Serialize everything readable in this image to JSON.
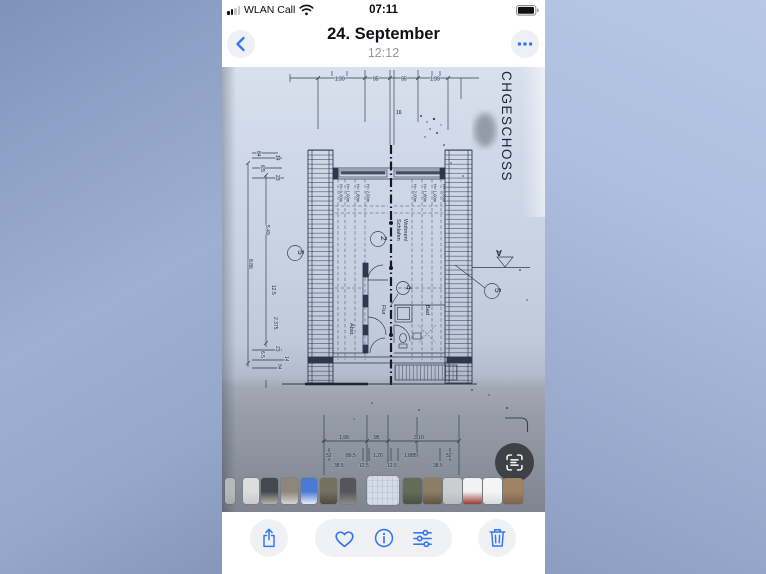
{
  "status": {
    "carrier": "WLAN Call",
    "time": "07:11",
    "icons": [
      "signal-bars-icon",
      "wifi-icon",
      "battery-icon"
    ]
  },
  "nav": {
    "title": "24. September",
    "subtitle": "12:12",
    "back_icon": "chevron-left-icon",
    "more_icon": "ellipsis-icon"
  },
  "plan": {
    "vertical_title": "CHGESCHOSS",
    "dims_top": [
      "1.99",
      "95",
      "95",
      "1.99"
    ],
    "dim_top_sub": "16",
    "left_col": {
      "top": [
        "84",
        "14",
        "6.5",
        "23"
      ],
      "main": [
        "5.49",
        "8.86",
        "12.5",
        "2.375"
      ],
      "bottom": [
        "23",
        "6.5",
        "14",
        "84"
      ]
    },
    "heights_left": [
      "H= 0,60m",
      "H= 1,00m",
      "H= 1,80m",
      "H= 2,00m"
    ],
    "heights_right": [
      "H= 2,00m",
      "H= 1,80m",
      "H= 1,00m",
      "H= 0,60m"
    ],
    "rooms": {
      "line1": "Wohnen/",
      "line2": "Schlafen",
      "flur": "Flur",
      "abst": "Abst.",
      "bad": "Bad"
    },
    "markers": {
      "stair_left": "5",
      "center": "2",
      "door": "4",
      "stair_right": "5",
      "section": "A"
    },
    "dims_bottom_row1": [
      "1,99",
      "95",
      "3,10"
    ],
    "dims_bottom_row2": [
      "52",
      "89,5",
      "1,20",
      "1,885",
      "52"
    ],
    "dims_bottom_row3": [
      "38,5",
      "12,5",
      "12,5",
      "38,5"
    ]
  },
  "live_text_icon": "live-text-scan-icon",
  "thumbnails": [
    {
      "label": "photo-edge",
      "c1": "#b6b9bc",
      "c2": "#a9acae"
    },
    {
      "label": "white-wall",
      "c1": "#dcdddd",
      "c2": "#c9cbcc"
    },
    {
      "label": "kitchen-dark",
      "c1": "#44494f",
      "c2": "#b9b2a4"
    },
    {
      "label": "door",
      "c1": "#8f857a",
      "c2": "#d6d4d0"
    },
    {
      "label": "blue-sign",
      "c1": "#4a79d6",
      "c2": "#e8ecf2"
    },
    {
      "label": "interior-mixed",
      "c1": "#75705f",
      "c2": "#4e4a42"
    },
    {
      "label": "dark-room",
      "c1": "#54565a",
      "c2": "#8e8a82"
    },
    {
      "label": "floorplan-current",
      "c1": "#d4dbe7",
      "c2": "#c3ccda",
      "current": true
    },
    {
      "label": "interior-green",
      "c1": "#646b58",
      "c2": "#4b5243"
    },
    {
      "label": "wood-interior",
      "c1": "#8d7d64",
      "c2": "#5e5443"
    },
    {
      "label": "gray-paper",
      "c1": "#cbcdcf",
      "c2": "#b9bbbd"
    },
    {
      "label": "document-red",
      "c1": "#f2f2f2",
      "c2": "#9c3a33"
    },
    {
      "label": "document-lines",
      "c1": "#f5f5f5",
      "c2": "#d9dadc"
    },
    {
      "label": "warm-interior",
      "c1": "#a08365",
      "c2": "#7d6348"
    }
  ],
  "toolbar": {
    "buttons": [
      {
        "name": "share",
        "icon": "share-icon"
      },
      {
        "name": "favorite",
        "icon": "heart-icon"
      },
      {
        "name": "info",
        "icon": "info-icon"
      },
      {
        "name": "adjust",
        "icon": "sliders-icon"
      },
      {
        "name": "delete",
        "icon": "trash-icon"
      }
    ]
  },
  "colors": {
    "accent_blue": "#3478f6",
    "paper": "#c9d3e2",
    "shadow_gray": "#9aa1ab",
    "ink": "#2e374e"
  }
}
